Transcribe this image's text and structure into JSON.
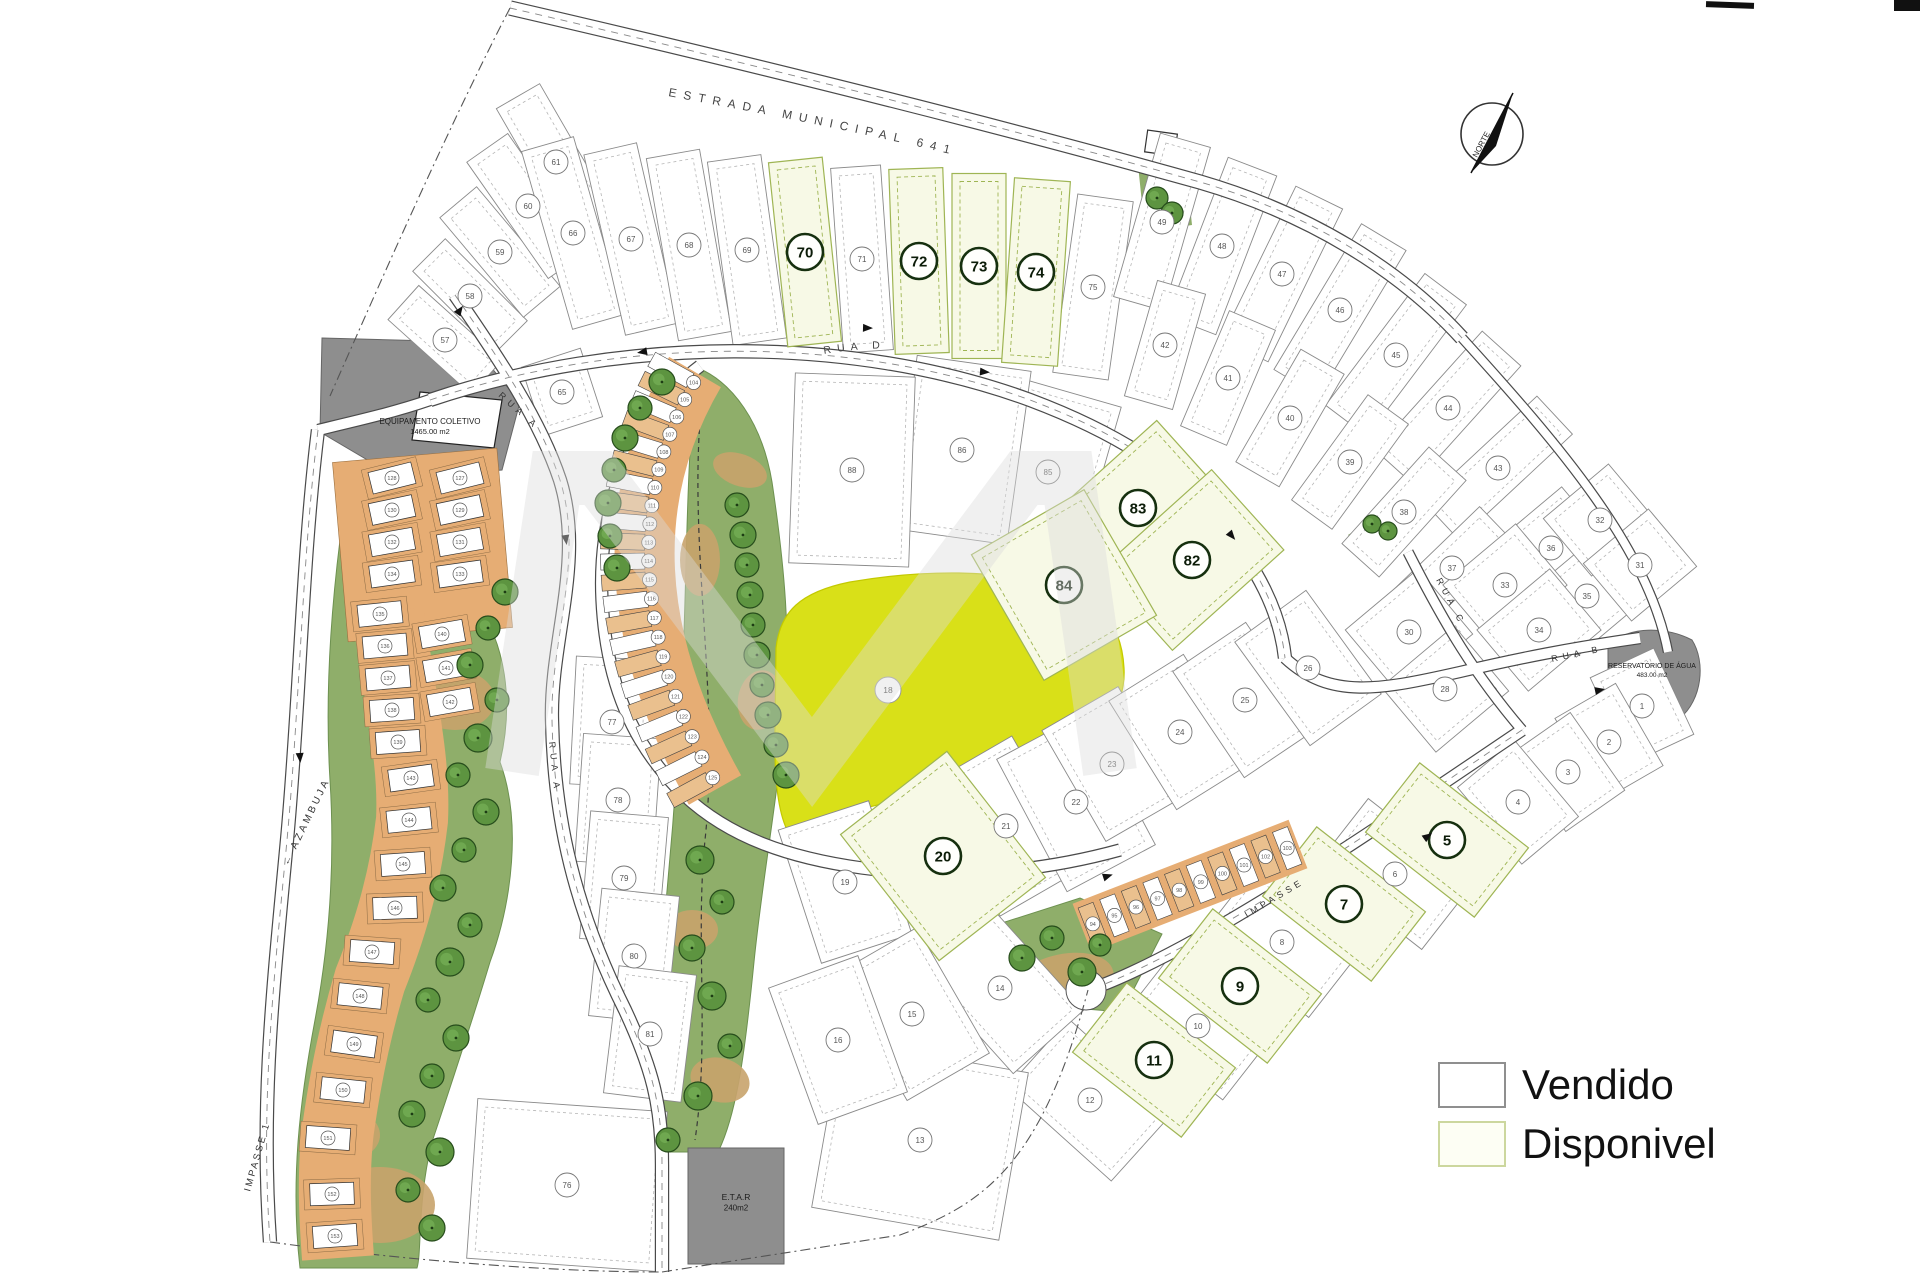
{
  "legend": {
    "items": [
      {
        "label": "Vendido",
        "fill": "#ffffff",
        "border": "#8f8f8f"
      },
      {
        "label": "Disponivel",
        "fill": "#fdfef4",
        "border": "#ccd79e"
      }
    ]
  },
  "compass": {
    "label": "NORTE"
  },
  "roads": {
    "estrada": "ESTRADA MUNICIPAL 641",
    "rua_a": "RUA A",
    "rua_b": "RUA B",
    "rua_c": "RUA C",
    "rua_d": "RUA D",
    "azambuja": "← AZAMBUJA",
    "impasse_1": "IMPASSE 1",
    "impasse": "IMPASSE"
  },
  "areas": {
    "equipamento": {
      "line1": "EQUIPAMENTO COLETIVO",
      "line2": "1465.00 m2"
    },
    "reservatorio": {
      "line1": "RESERVATÓRIO DE ÁGUA",
      "line2": "483.00 m2"
    },
    "etar": {
      "line1": "E.T.A.R",
      "line2": "240m2"
    },
    "central_circle": "18"
  },
  "colors": {
    "available_fill": "#f7f9e6",
    "available_border": "#9fb554",
    "leisure_yellow": "#d9e018",
    "park_green": "#8fae6a",
    "sand": "#c8a36b",
    "townhouse_orange": "#e6ad74",
    "gray_area": "#8e8e8e",
    "road_casing": "#4a4a4a"
  },
  "lots": {
    "available": [
      [
        70,
        805,
        252,
        54,
        185,
        -6
      ],
      [
        72,
        919,
        261,
        54,
        185,
        -2
      ],
      [
        73,
        979,
        266,
        54,
        185,
        0
      ],
      [
        74,
        1036,
        272,
        56,
        185,
        4
      ],
      [
        83,
        1138,
        508,
        145,
        105,
        -42
      ],
      [
        82,
        1192,
        560,
        150,
        108,
        -42
      ],
      [
        84,
        1064,
        585,
        130,
        145,
        -30
      ],
      [
        20,
        943,
        856,
        135,
        160,
        -38
      ],
      [
        5,
        1447,
        840,
        88,
        138,
        -52
      ],
      [
        7,
        1344,
        904,
        88,
        138,
        -52
      ],
      [
        9,
        1240,
        986,
        88,
        138,
        -52
      ],
      [
        11,
        1154,
        1060,
        88,
        138,
        -52
      ]
    ],
    "sold": [
      [
        57,
        445,
        340,
        46,
        112,
        -48
      ],
      [
        58,
        470,
        296,
        46,
        116,
        -45
      ],
      [
        59,
        500,
        252,
        48,
        130,
        -40
      ],
      [
        60,
        528,
        206,
        50,
        142,
        -35
      ],
      [
        61,
        556,
        162,
        50,
        152,
        -30
      ],
      [
        65,
        562,
        392,
        62,
        72,
        -18
      ],
      [
        66,
        573,
        233,
        54,
        185,
        -16
      ],
      [
        67,
        631,
        239,
        54,
        185,
        -13
      ],
      [
        68,
        689,
        245,
        54,
        185,
        -10
      ],
      [
        69,
        747,
        250,
        54,
        185,
        -8
      ],
      [
        71,
        862,
        259,
        50,
        185,
        -4
      ],
      [
        75,
        1093,
        287,
        56,
        180,
        8
      ],
      [
        49,
        1162,
        222,
        52,
        170,
        16
      ],
      [
        48,
        1222,
        246,
        52,
        170,
        21
      ],
      [
        47,
        1282,
        274,
        52,
        170,
        26
      ],
      [
        46,
        1340,
        310,
        52,
        170,
        31
      ],
      [
        45,
        1396,
        355,
        52,
        165,
        37
      ],
      [
        44,
        1448,
        408,
        52,
        160,
        42
      ],
      [
        43,
        1498,
        468,
        52,
        155,
        47
      ],
      [
        42,
        1165,
        345,
        50,
        120,
        16
      ],
      [
        41,
        1228,
        378,
        50,
        125,
        23
      ],
      [
        40,
        1290,
        418,
        50,
        130,
        30
      ],
      [
        39,
        1350,
        462,
        50,
        130,
        36
      ],
      [
        38,
        1404,
        512,
        50,
        130,
        42
      ],
      [
        37,
        1452,
        568,
        50,
        125,
        46
      ],
      [
        36,
        1551,
        548,
        95,
        80,
        -40
      ],
      [
        35,
        1587,
        596,
        95,
        80,
        -40
      ],
      [
        33,
        1505,
        585,
        95,
        80,
        -40
      ],
      [
        34,
        1539,
        630,
        95,
        80,
        -40
      ],
      [
        32,
        1600,
        520,
        85,
        75,
        -40
      ],
      [
        31,
        1640,
        565,
        85,
        75,
        -40
      ],
      [
        30,
        1409,
        632,
        95,
        85,
        -40
      ],
      [
        28,
        1445,
        689,
        95,
        85,
        -40
      ],
      [
        1,
        1642,
        706,
        70,
        95,
        -25
      ],
      [
        2,
        1609,
        742,
        70,
        95,
        -30
      ],
      [
        3,
        1568,
        772,
        72,
        95,
        -35
      ],
      [
        4,
        1518,
        802,
        74,
        100,
        -40
      ],
      [
        6,
        1395,
        874,
        86,
        135,
        -52
      ],
      [
        8,
        1282,
        942,
        86,
        135,
        -52
      ],
      [
        10,
        1198,
        1026,
        86,
        130,
        -52
      ],
      [
        12,
        1090,
        1100,
        92,
        140,
        -48
      ],
      [
        85,
        1048,
        472,
        105,
        165,
        16
      ],
      [
        86,
        962,
        450,
        115,
        175,
        8
      ],
      [
        88,
        852,
        470,
        120,
        190,
        2
      ],
      [
        21,
        1006,
        826,
        100,
        150,
        -30
      ],
      [
        22,
        1076,
        802,
        100,
        150,
        -28
      ],
      [
        19,
        845,
        882,
        95,
        140,
        -18
      ],
      [
        23,
        1112,
        764,
        88,
        128,
        -30
      ],
      [
        24,
        1180,
        732,
        88,
        128,
        -32
      ],
      [
        25,
        1245,
        700,
        88,
        128,
        -34
      ],
      [
        26,
        1308,
        668,
        88,
        128,
        -36
      ],
      [
        13,
        920,
        1140,
        190,
        170,
        10
      ],
      [
        76,
        567,
        1185,
        190,
        160,
        4
      ],
      [
        77,
        612,
        722,
        78,
        128,
        3
      ],
      [
        78,
        618,
        800,
        78,
        128,
        4
      ],
      [
        79,
        624,
        878,
        78,
        128,
        5
      ],
      [
        80,
        634,
        956,
        78,
        128,
        6
      ],
      [
        81,
        650,
        1034,
        78,
        128,
        7
      ],
      [
        14,
        1000,
        988,
        95,
        145,
        -42
      ],
      [
        15,
        912,
        1014,
        95,
        145,
        -30
      ],
      [
        16,
        838,
        1040,
        95,
        145,
        -20
      ]
    ],
    "left_units": [
      [
        127,
        460,
        478,
        -14
      ],
      [
        129,
        460,
        510,
        -12
      ],
      [
        131,
        460,
        542,
        -10
      ],
      [
        133,
        460,
        574,
        -8
      ],
      [
        128,
        392,
        478,
        -14
      ],
      [
        130,
        392,
        510,
        -12
      ],
      [
        132,
        392,
        542,
        -10
      ],
      [
        134,
        392,
        574,
        -8
      ],
      [
        135,
        380,
        614,
        -6
      ],
      [
        136,
        385,
        646,
        -5
      ],
      [
        137,
        388,
        678,
        -5
      ],
      [
        138,
        392,
        710,
        -4
      ],
      [
        139,
        398,
        742,
        -4
      ],
      [
        140,
        442,
        634,
        -10
      ],
      [
        141,
        446,
        668,
        -10
      ],
      [
        142,
        450,
        702,
        -10
      ],
      [
        143,
        411,
        778,
        -8
      ],
      [
        144,
        409,
        820,
        -6
      ],
      [
        145,
        403,
        864,
        -4
      ],
      [
        146,
        395,
        908,
        -2
      ],
      [
        147,
        372,
        952,
        4
      ],
      [
        148,
        360,
        996,
        6
      ],
      [
        149,
        354,
        1044,
        8
      ],
      [
        150,
        343,
        1090,
        6
      ],
      [
        151,
        328,
        1138,
        4
      ],
      [
        152,
        332,
        1194,
        -2
      ],
      [
        153,
        335,
        1236,
        -4
      ]
    ],
    "arc_units": {
      "start": 104,
      "count": 22
    },
    "strip_units": {
      "start": 94,
      "count": 10
    }
  },
  "trees": [
    [
      662,
      382,
      13
    ],
    [
      640,
      408,
      12
    ],
    [
      625,
      438,
      13
    ],
    [
      614,
      470,
      12
    ],
    [
      608,
      503,
      13
    ],
    [
      610,
      536,
      12
    ],
    [
      617,
      568,
      13
    ],
    [
      737,
      505,
      12
    ],
    [
      743,
      535,
      13
    ],
    [
      747,
      565,
      12
    ],
    [
      750,
      595,
      13
    ],
    [
      753,
      625,
      12
    ],
    [
      757,
      655,
      13
    ],
    [
      762,
      685,
      12
    ],
    [
      768,
      715,
      13
    ],
    [
      776,
      745,
      12
    ],
    [
      786,
      775,
      13
    ],
    [
      700,
      860,
      14
    ],
    [
      722,
      902,
      12
    ],
    [
      692,
      948,
      13
    ],
    [
      712,
      996,
      14
    ],
    [
      730,
      1046,
      12
    ],
    [
      698,
      1096,
      14
    ],
    [
      668,
      1140,
      12
    ],
    [
      505,
      592,
      13
    ],
    [
      488,
      628,
      12
    ],
    [
      470,
      665,
      13
    ],
    [
      497,
      700,
      12
    ],
    [
      478,
      738,
      14
    ],
    [
      458,
      775,
      12
    ],
    [
      486,
      812,
      13
    ],
    [
      464,
      850,
      12
    ],
    [
      443,
      888,
      13
    ],
    [
      470,
      925,
      12
    ],
    [
      450,
      962,
      14
    ],
    [
      428,
      1000,
      12
    ],
    [
      456,
      1038,
      13
    ],
    [
      432,
      1076,
      12
    ],
    [
      412,
      1114,
      13
    ],
    [
      440,
      1152,
      14
    ],
    [
      408,
      1190,
      12
    ],
    [
      432,
      1228,
      13
    ],
    [
      1022,
      958,
      13
    ],
    [
      1052,
      938,
      12
    ],
    [
      1082,
      972,
      14
    ],
    [
      1100,
      945,
      11
    ],
    [
      1157,
      198,
      11
    ],
    [
      1172,
      213,
      11
    ],
    [
      1372,
      524,
      9
    ],
    [
      1388,
      531,
      9
    ]
  ]
}
